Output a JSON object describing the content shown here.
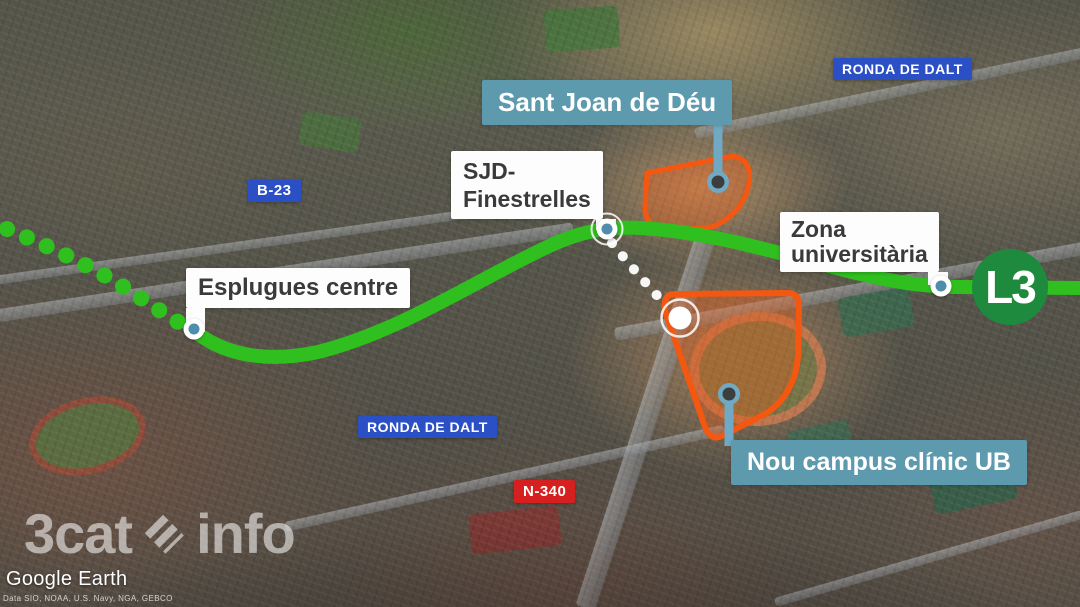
{
  "stations": {
    "esplugues": {
      "label": "Esplugues centre"
    },
    "sjd": {
      "line1": "SJD-",
      "line2": "Finestrelles"
    },
    "zona": {
      "line1": "Zona",
      "line2": "universitària"
    }
  },
  "areas": {
    "hospital": {
      "label": "Sant Joan de Déu"
    },
    "campus": {
      "label": "Nou campus clínic UB"
    }
  },
  "roads": {
    "b23": {
      "label": "B-23"
    },
    "ronda_top": {
      "label": "RONDA DE DALT"
    },
    "ronda_bottom": {
      "label": "RONDA DE DALT"
    },
    "n340": {
      "label": "N-340"
    }
  },
  "line_badge": {
    "label": "L3"
  },
  "watermark": {
    "brand_left": "3cat",
    "brand_right": "info"
  },
  "attribution": {
    "provider": "Google Earth",
    "credits": "Data SIO, NOAA, U.S. Navy, NGA, GEBCO"
  },
  "colors": {
    "line-green": "#2fc01f",
    "line-green-dark": "#1e8a3e",
    "teal-label": "#5d9aad",
    "teal-dot": "#4e8dab",
    "connector": "#6fa9c4",
    "orange": "#f4570f",
    "road-blue": "#2b4fc4",
    "road-red": "#d61f1f",
    "ink": "#3a3a3a"
  }
}
